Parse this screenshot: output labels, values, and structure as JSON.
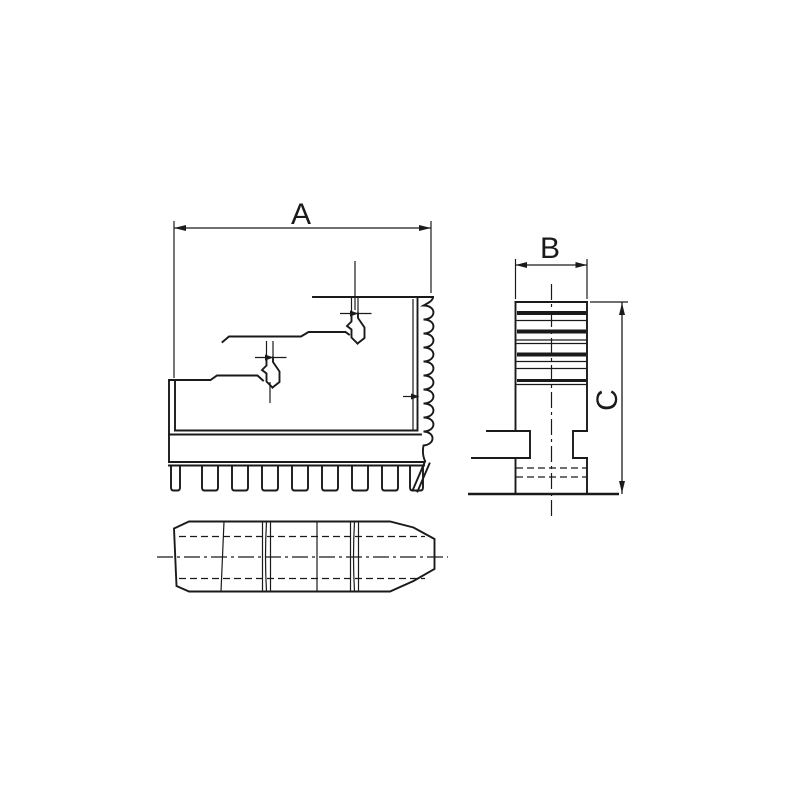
{
  "drawing": {
    "dimension_labels": {
      "a": "A",
      "b": "B",
      "c": "C"
    },
    "colors": {
      "line": "#1a1a1a",
      "background": "#ffffff"
    }
  }
}
